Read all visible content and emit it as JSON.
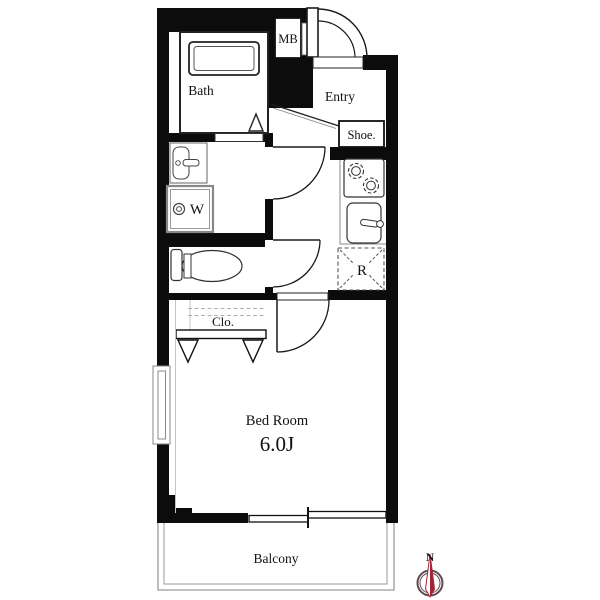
{
  "plan": {
    "title": "1K apartment floor plan",
    "labels": {
      "bath": "Bath",
      "meter_box": "MB",
      "entry": "Entry",
      "shoe_box": "Shoe.",
      "washer": "W",
      "refrigerator": "R",
      "closet": "Clo.",
      "bedroom_name": "Bed Room",
      "bedroom_size": "6.0J",
      "balcony": "Balcony",
      "compass_north": "N"
    },
    "colors": {
      "wall": "#0c0c0c",
      "outline": "#1a1a1a",
      "balcony_line": "#9a9a9a",
      "compass": "#a32638",
      "compass_ring": "#5e4a4e"
    }
  }
}
